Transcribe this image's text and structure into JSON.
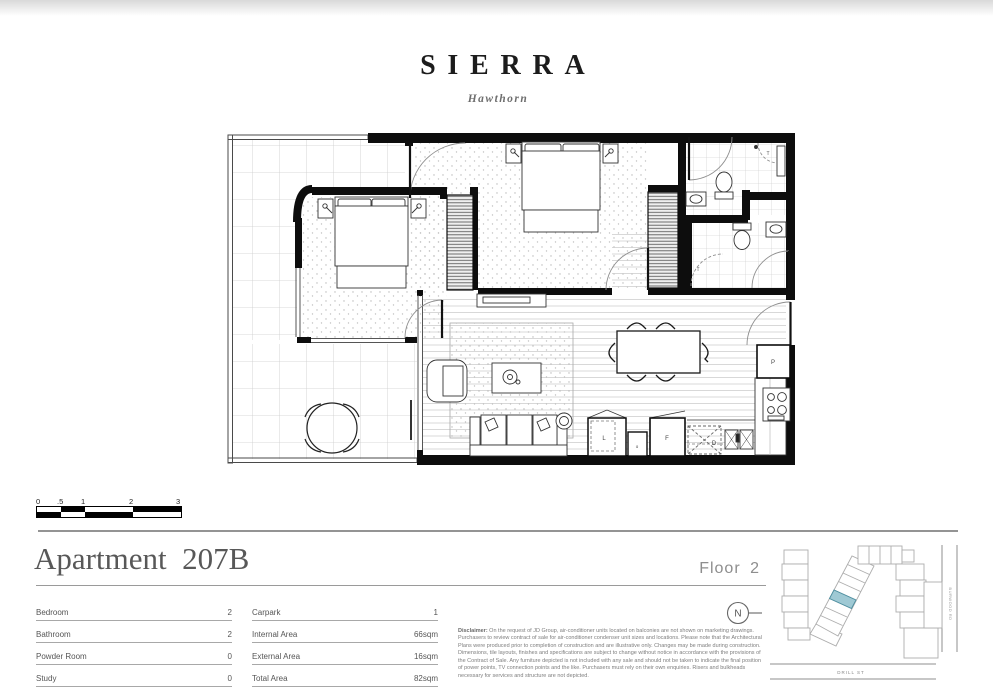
{
  "branding": {
    "title": "SIERRA",
    "subtitle": "Hawthorn"
  },
  "apartment": {
    "title": "Apartment  207B",
    "floor_label": "Floor 2"
  },
  "specs_left": [
    {
      "label": "Bedroom",
      "value": "2"
    },
    {
      "label": "Bathroom",
      "value": "2"
    },
    {
      "label": "Powder Room",
      "value": "0"
    },
    {
      "label": "Study",
      "value": "0"
    }
  ],
  "specs_right": [
    {
      "label": "Carpark",
      "value": "1"
    },
    {
      "label": "Internal Area",
      "value": "66sqm"
    },
    {
      "label": "External Area",
      "value": "16sqm"
    },
    {
      "label": "Total Area",
      "value": "82sqm"
    }
  ],
  "disclaimer": {
    "lead": "Disclaimer:",
    "body": " On the request of JD Group, air-conditioner units located on balconies are not shown on marketing drawings. Purchasers to review contract of sale for air-conditioner condenser unit sizes and locations. Please note that the Architectural Plans were produced prior to completion of construction and are illustrative only. Changes may be made during construction. Dimensions, tile layouts, finishes and specifications are subject to change without notice in accordance with the provisions of the Contract of Sale. Any furniture depicted is not included with any sale and should not be taken to indicate the final position of power points, TV connection points and the like. Purchasers must rely on their own enquiries. Risers and bulkheads necessary for services and structure are not depicted."
  },
  "scale_bar": {
    "labels": [
      "0",
      ".5",
      "1",
      "2",
      "3"
    ]
  },
  "compass": {
    "letter": "N"
  },
  "plan": {
    "labels": {
      "pantry": "P",
      "laundry": "L",
      "fridge": "F",
      "dishwasher": "D",
      "small_appliance": "o",
      "shower_door_1": "T",
      "shower_door_2": "T"
    }
  },
  "map": {
    "street_bottom": "DRILL ST",
    "street_right": "BURWOOD RD",
    "highlight_color": "#9fc9d4"
  },
  "colors": {
    "wall": "#0d0d0d",
    "accent_teal": "#9fc9d4",
    "rule_gray": "#9a9a9a"
  }
}
